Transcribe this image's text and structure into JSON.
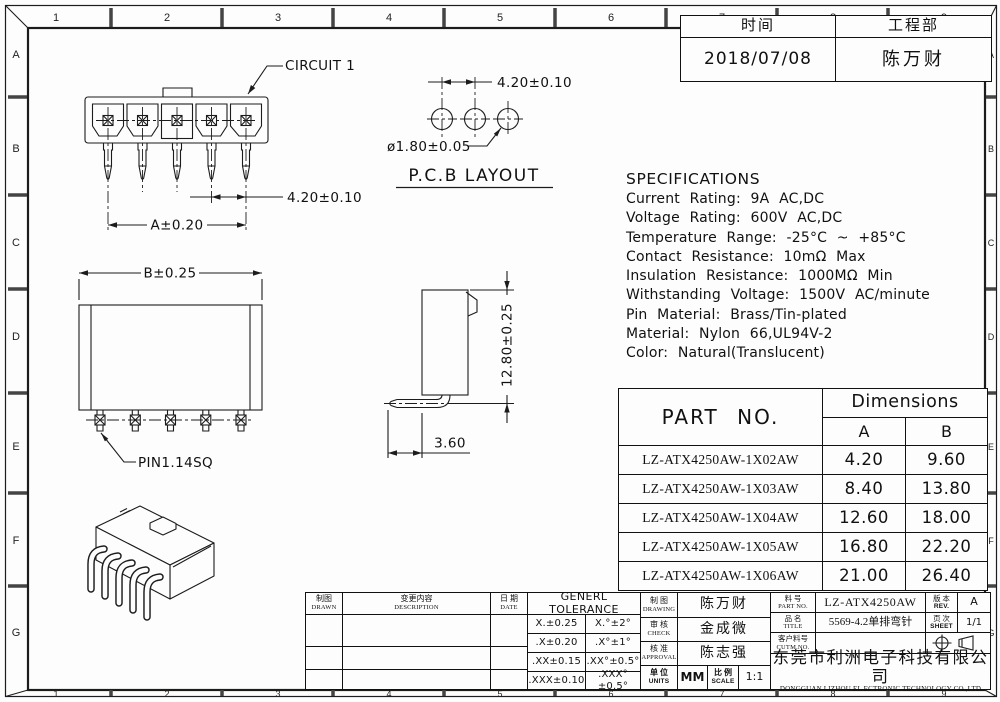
{
  "zones": {
    "cols": [
      "1",
      "2",
      "3",
      "4",
      "5",
      "6",
      "7",
      "8",
      "9"
    ],
    "rows": [
      "A",
      "B",
      "C",
      "D",
      "E",
      "F",
      "G"
    ]
  },
  "meta_table": {
    "time_label": "时间",
    "dept_label": "工程部",
    "date": "2018/07/08",
    "engineer": "陈万财"
  },
  "front_view": {
    "circuit_label": "CIRCUIT 1",
    "pitch_dim": "4.20±0.10",
    "width_dim": "A±0.20"
  },
  "pcb_view": {
    "title": "P.C.B LAYOUT",
    "pitch_dim": "4.20±0.10",
    "hole_dim": "ø1.80±0.05"
  },
  "bottom_view": {
    "width_dim": "B±0.25",
    "pin_label": "PIN1.14SQ"
  },
  "side_view": {
    "height_dim": "12.80±0.25",
    "tail_dim": "3.60"
  },
  "specifications": {
    "title": "SPECIFICATIONS",
    "lines": [
      "Current Rating: 9A AC,DC",
      "Voltage Rating: 600V AC,DC",
      "Temperature Range: -25°C ~ +85°C",
      "Contact Resistance: 10mΩ Max",
      "Insulation Resistance: 1000MΩ Min",
      "Withstanding Voltage: 1500V AC/minute",
      "Pin Material: Brass/Tin-plated",
      "Material: Nylon 66,UL94V-2",
      "Color: Natural(Translucent)"
    ]
  },
  "part_table": {
    "part_header": "PART NO.",
    "dims_header": "Dimensions",
    "col_a": "A",
    "col_b": "B",
    "rows": [
      {
        "part": "LZ-ATX4250AW-1X02AW",
        "a": "4.20",
        "b": "9.60"
      },
      {
        "part": "LZ-ATX4250AW-1X03AW",
        "a": "8.40",
        "b": "13.80"
      },
      {
        "part": "LZ-ATX4250AW-1X04AW",
        "a": "12.60",
        "b": "18.00"
      },
      {
        "part": "LZ-ATX4250AW-1X05AW",
        "a": "16.80",
        "b": "22.20"
      },
      {
        "part": "LZ-ATX4250AW-1X06AW",
        "a": "21.00",
        "b": "26.40"
      }
    ]
  },
  "title_block": {
    "drawn_zh": "制图",
    "drawn_en": "DRAWN",
    "desc_zh": "变更内容",
    "desc_en": "DESCRIPTION",
    "date_zh": "日 期",
    "date_en": "DATE",
    "tolerance_title": "GENERL TOLERANCE",
    "tolerances": [
      {
        "lin": "X.±0.25",
        "ang": "X.°±2°"
      },
      {
        "lin": ".X±0.20",
        "ang": ".X°±1°"
      },
      {
        "lin": ".XX±0.15",
        "ang": ".XX°±0.5°"
      },
      {
        "lin": ".XXX±0.10",
        "ang": ".XXX°±0.5°"
      }
    ],
    "drawing_zh": "制 图",
    "drawing_en": "DRAWING",
    "drawing_value": "陈万财",
    "check_zh": "审 核",
    "check_en": "CHECK",
    "check_value": "金成微",
    "approval_zh": "核 准",
    "approval_en": "APPROVAL",
    "approval_value": "陈志强",
    "units_zh": "单 位",
    "units_en": "UNITS",
    "units_value": "MM",
    "scale_zh": "比 例",
    "scale_en": "SCALE",
    "scale_value": "1:1",
    "partno_zh": "料 号",
    "partno_en": "PART NO.",
    "partno_value": "LZ-ATX4250AW",
    "title_zh": "品 名",
    "title_en": "TITLE",
    "title_value": "5569-4.2单排弯针",
    "custno_zh": "客户料号",
    "custno_en": "CUTM.NO.",
    "custno_value": "",
    "rev_zh": "版 本",
    "rev_en": "REV.",
    "rev_value": "A",
    "sheet_zh": "页 次",
    "sheet_en": "SHEET",
    "sheet_value": "1/1",
    "company_zh": "东莞市利洲电子科技有限公司",
    "company_en": "DONGGUAN LIZHOU EL ECTRONIC TECHNOLOGY CO.,LTD"
  }
}
